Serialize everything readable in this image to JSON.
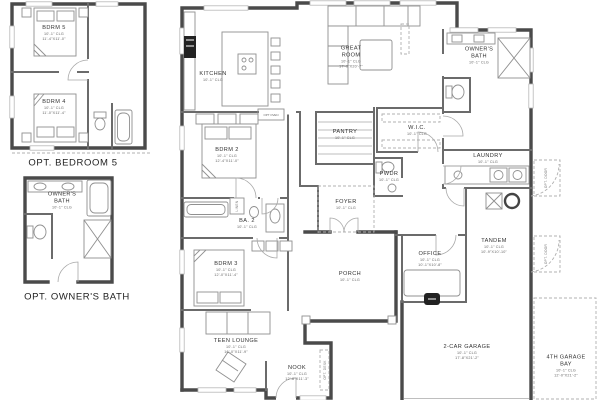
{
  "captions": {
    "opt_bedroom5": "OPT. BEDROOM 5",
    "opt_owners_bath": "OPT. OWNER'S BATH"
  },
  "rooms": {
    "bdrm5": {
      "name": "BDRM 5",
      "clg": "10'-1\" CLG",
      "dim": "11'-4\"X11'-0\""
    },
    "bdrm4": {
      "name": "BDRM 4",
      "clg": "10'-1\" CLG",
      "dim": "11'-0\"X11'-4\""
    },
    "owners_bath_opt": {
      "name": "OWNER'S BATH",
      "clg": "10'-1\" CLG"
    },
    "kitchen": {
      "name": "KITCHEN",
      "clg": "10'-1\" CLG"
    },
    "great_room": {
      "name": "GREAT ROOM",
      "clg": "10'-1\" CLG",
      "dim": "17'-0\"X20'-7\""
    },
    "owners_bath": {
      "name": "OWNER'S BATH",
      "clg": "10'-1\" CLG"
    },
    "pantry": {
      "name": "PANTRY",
      "clg": "10'-1\" CLG"
    },
    "wic": {
      "name": "W.I.C.",
      "clg": "10'-1\" CLG"
    },
    "laundry": {
      "name": "LAUNDRY",
      "clg": "10'-1\" CLG"
    },
    "pwdr": {
      "name": "PWDR",
      "clg": "10'-1\" CLG"
    },
    "bdrm2": {
      "name": "BDRM 2",
      "clg": "10'-1\" CLG",
      "dim": "12'-4\"X11'-0\""
    },
    "ba2": {
      "name": "BA. 2",
      "clg": "10'-1\" CLG"
    },
    "foyer": {
      "name": "FOYER",
      "clg": "10'-1\" CLG"
    },
    "porch": {
      "name": "PORCH",
      "clg": "10'-1\" CLG"
    },
    "office": {
      "name": "OFFICE",
      "clg": "10'-1\" CLG",
      "dim": "10'-1\"X10'-8\""
    },
    "tandem": {
      "name": "TANDEM",
      "clg": "10'-1\" CLG",
      "dim": "10'-9\"X10'-10\""
    },
    "bdrm3": {
      "name": "BDRM 3",
      "clg": "10'-1\" CLG",
      "dim": "12'-0\"X11'-4\""
    },
    "teen_lounge": {
      "name": "TEEN LOUNGE",
      "clg": "10'-1\" CLG",
      "dim": "16'-0\"X11'-9\""
    },
    "nook": {
      "name": "NOOK",
      "clg": "10'-1\" CLG",
      "dim": "12'-8\"X11'-3\""
    },
    "garage2": {
      "name": "2-CAR GARAGE",
      "clg": "10'-1\" CLG",
      "dim": "17'-8\"X21'-2\""
    },
    "garage4": {
      "name": "4TH GARAGE BAY",
      "clg": "10'-1\" CLG",
      "dim": "12'-0\"X21'-2\""
    }
  },
  "annotations": {
    "linen": "LINEN",
    "opt_oven": "OPT OVEN",
    "opt_desk": "OPT. DESK",
    "opt_door": "OPT. DOOR"
  },
  "colors": {
    "wall_dark": "#4a4a4a",
    "wall_mid": "#6b6b6b",
    "fixture": "#909090",
    "dashed": "#b0b0b0",
    "black_item": "#222222",
    "background": "#ffffff"
  }
}
